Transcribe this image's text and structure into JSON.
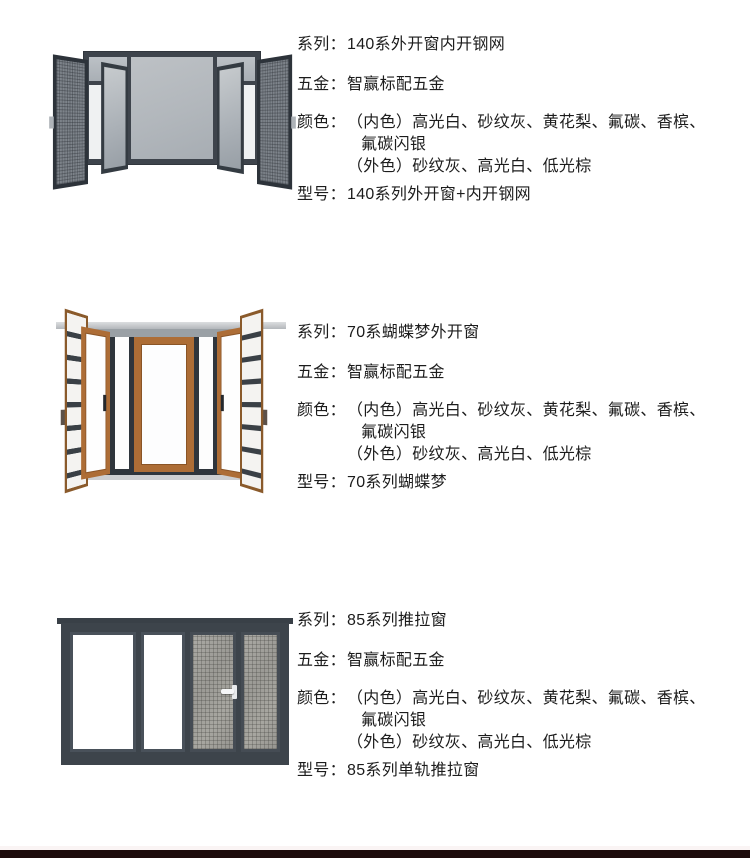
{
  "page": {
    "background_color": "#ffffff",
    "text_color": "#1c1c1c",
    "bottom_bar_color": "#1d0b0b"
  },
  "labels": {
    "series": "系列：",
    "hardware": "五金：",
    "color": "颜色：",
    "model": "型号："
  },
  "products": [
    {
      "series": "140系外开窗内开钢网",
      "hardware": "智赢标配五金",
      "color_line1": "（内色）高光白、砂纹灰、黄花梨、氟碳、香槟、",
      "color_line2": "氟碳闪银",
      "color_line3": "（外色）砂纹灰、高光白、低光棕",
      "model": "140系列外开窗+内开钢网",
      "photo": {
        "style": "dark-casement-window-with-mesh-screens",
        "frame_color": "#3e444c",
        "glass_color": "#b2b7bc",
        "mesh_color": "#7d838a"
      }
    },
    {
      "series": "70系蝴蝶梦外开窗",
      "hardware": "智赢标配五金",
      "color_line1": "（内色）高光白、砂纹灰、黄花梨、氟碳、香槟、",
      "color_line2": "氟碳闪银",
      "color_line3": "（外色）砂纹灰、高光白、低光棕",
      "model": "70系列蝴蝶梦",
      "photo": {
        "style": "wood-tone-butterfly-casement-window",
        "wood_color": "#ad6d36",
        "glass_color": "#fdfdfe",
        "bar_color": "#3a4046"
      }
    },
    {
      "series": "85系列推拉窗",
      "hardware": "智赢标配五金",
      "color_line1": "（内色）高光白、砂纹灰、黄花梨、氟碳、香槟、",
      "color_line2": "氟碳闪银",
      "color_line3": "（外色）砂纹灰、高光白、低光棕",
      "model": "85系列单轨推拉窗",
      "photo": {
        "style": "dark-sliding-window-with-mesh",
        "frame_color": "#3d444b",
        "mesh_color": "#a0a09b",
        "handle_color": "#f5f6f7"
      }
    }
  ]
}
